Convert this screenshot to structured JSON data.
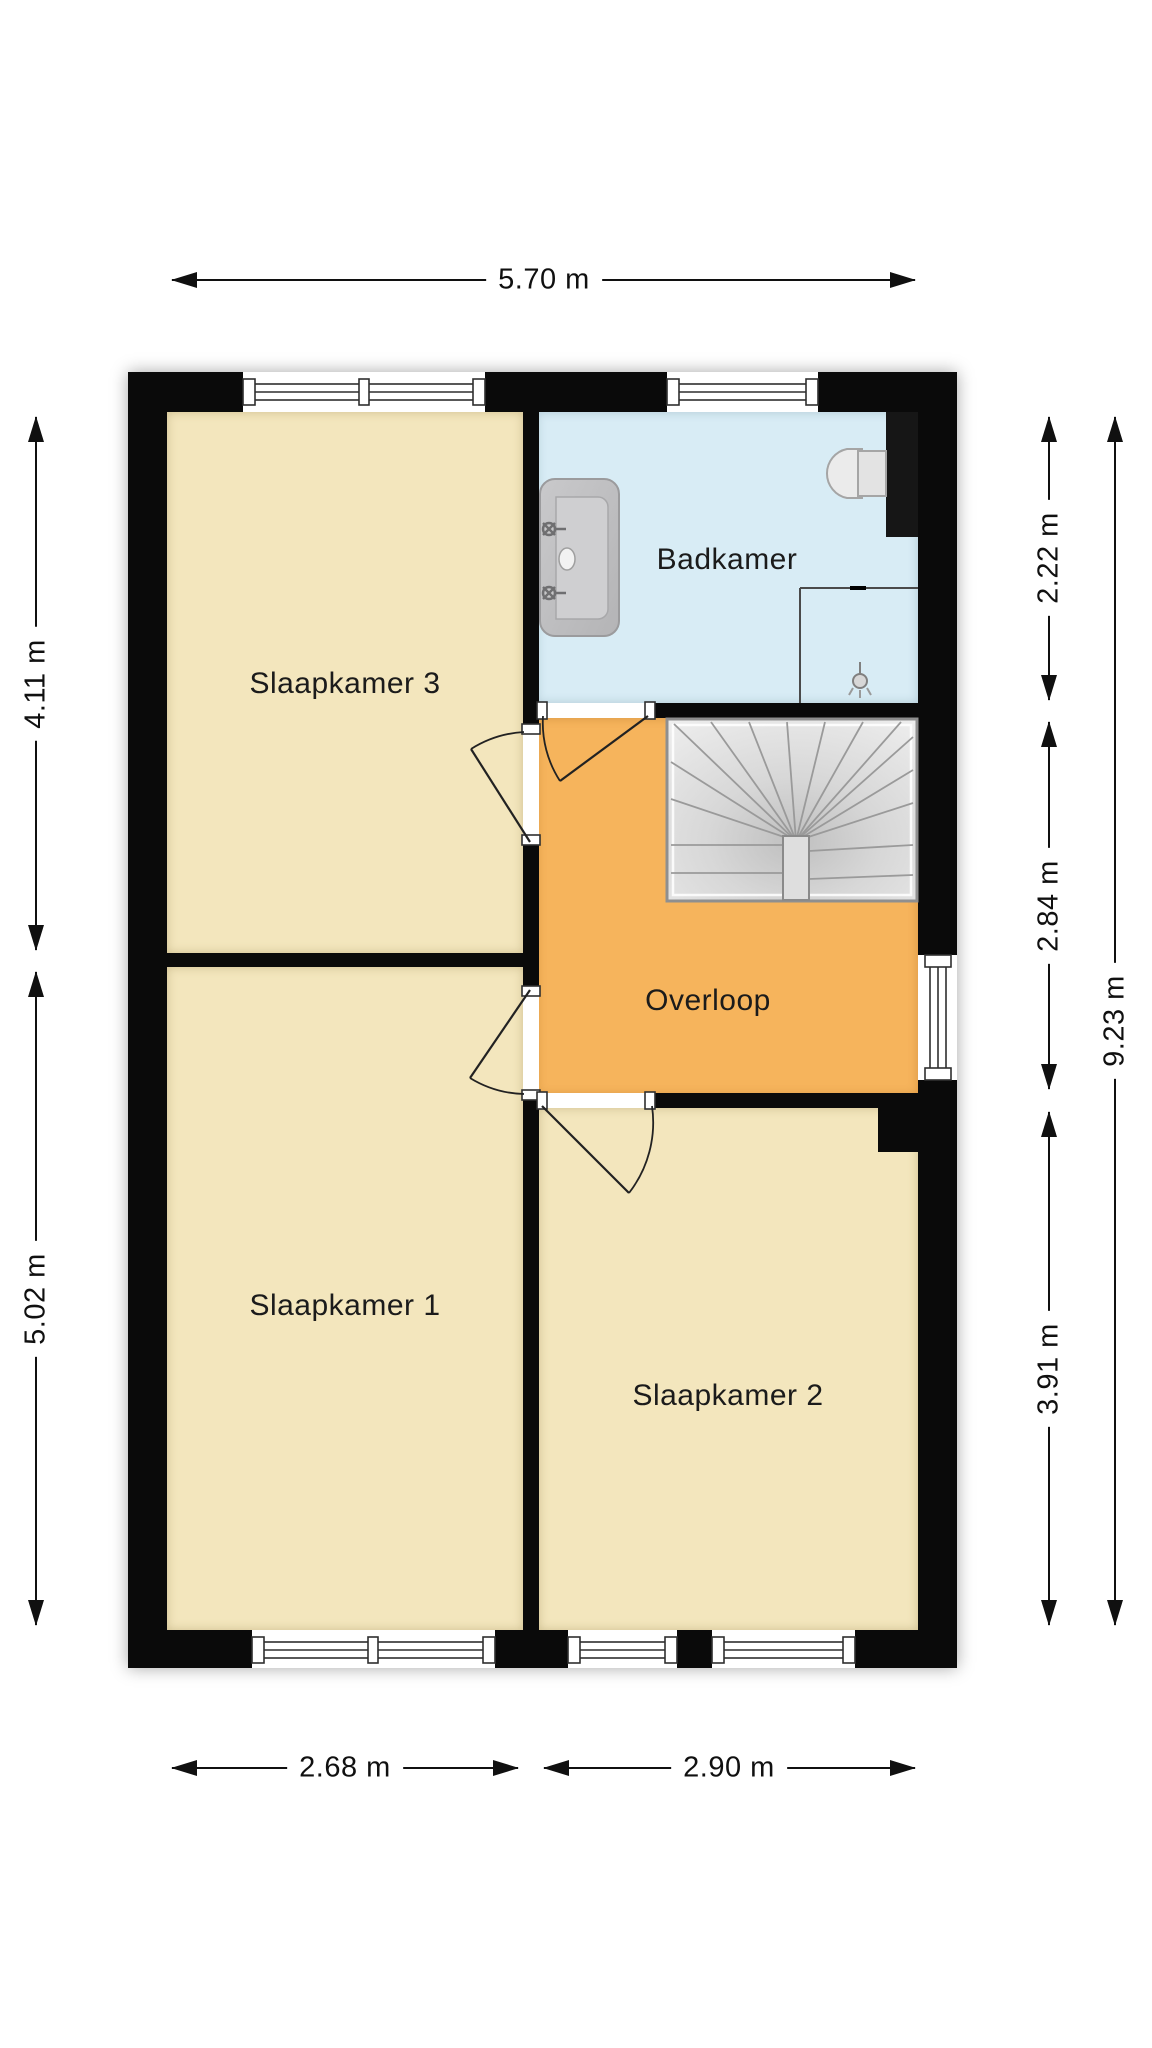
{
  "plan": {
    "type": "floor-plan",
    "floor_name": "verdieping",
    "rooms": [
      {
        "id": "slaapkamer3",
        "label": "Slaapkamer 3"
      },
      {
        "id": "badkamer",
        "label": "Badkamer"
      },
      {
        "id": "overloop",
        "label": "Overloop"
      },
      {
        "id": "slaapkamer1",
        "label": "Slaapkamer 1"
      },
      {
        "id": "slaapkamer2",
        "label": "Slaapkamer 2"
      }
    ],
    "dimensions": {
      "top_total_width": "5.70 m",
      "left_bedroom3_depth": "4.11 m",
      "left_bedroom1_depth": "5.02 m",
      "right_bathroom_depth": "2.22 m",
      "right_landing_depth": "2.84 m",
      "right_bedroom2_depth": "3.91 m",
      "right_total_depth": "9.23 m",
      "bottom_bedroom1_width": "2.68 m",
      "bottom_bedroom2_width": "2.90 m"
    },
    "fixtures": [
      {
        "id": "washbasin",
        "name": "washbasin-with-two-taps"
      },
      {
        "id": "toilet",
        "name": "toilet"
      },
      {
        "id": "shower",
        "name": "shower-corner"
      },
      {
        "id": "staircase",
        "name": "winder-staircase"
      }
    ],
    "colors": {
      "wall": "#0a0a0a",
      "bedroom_floor": "#f3e6bd",
      "bathroom_floor": "#d8ecf5",
      "landing_floor": "#f6b45c",
      "stair_tread": "#e2e2e2",
      "dimension_text": "#101010"
    }
  }
}
